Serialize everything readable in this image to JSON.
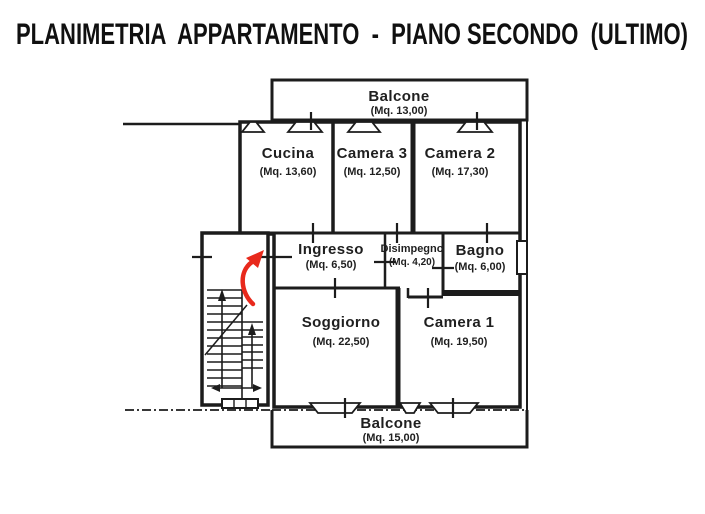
{
  "title": "PLANIMETRIA  APPARTAMENTO  -  PIANO SECONDO  (ULTIMO)",
  "colors": {
    "ink": "#1c1c1c",
    "entry_arrow": "#e8291c",
    "background": "#ffffff"
  },
  "balconies": {
    "top": {
      "name": "Balcone",
      "area": "(Mq. 13,00)"
    },
    "bottom": {
      "name": "Balcone",
      "area": "(Mq. 15,00)"
    }
  },
  "rooms": {
    "cucina": {
      "name": "Cucina",
      "area": "(Mq. 13,60)"
    },
    "camera3": {
      "name": "Camera 3",
      "area": "(Mq. 12,50)"
    },
    "camera2": {
      "name": "Camera 2",
      "area": "(Mq. 17,30)"
    },
    "ingresso": {
      "name": "Ingresso",
      "area": "(Mq. 6,50)"
    },
    "disimpegno": {
      "name": "Disimpegno",
      "area": "(Mq. 4,20)"
    },
    "bagno": {
      "name": "Bagno",
      "area": "(Mq. 6,00)"
    },
    "soggiorno": {
      "name": "Soggiorno",
      "area": "(Mq. 22,50)"
    },
    "camera1": {
      "name": "Camera 1",
      "area": "(Mq. 19,50)"
    }
  }
}
